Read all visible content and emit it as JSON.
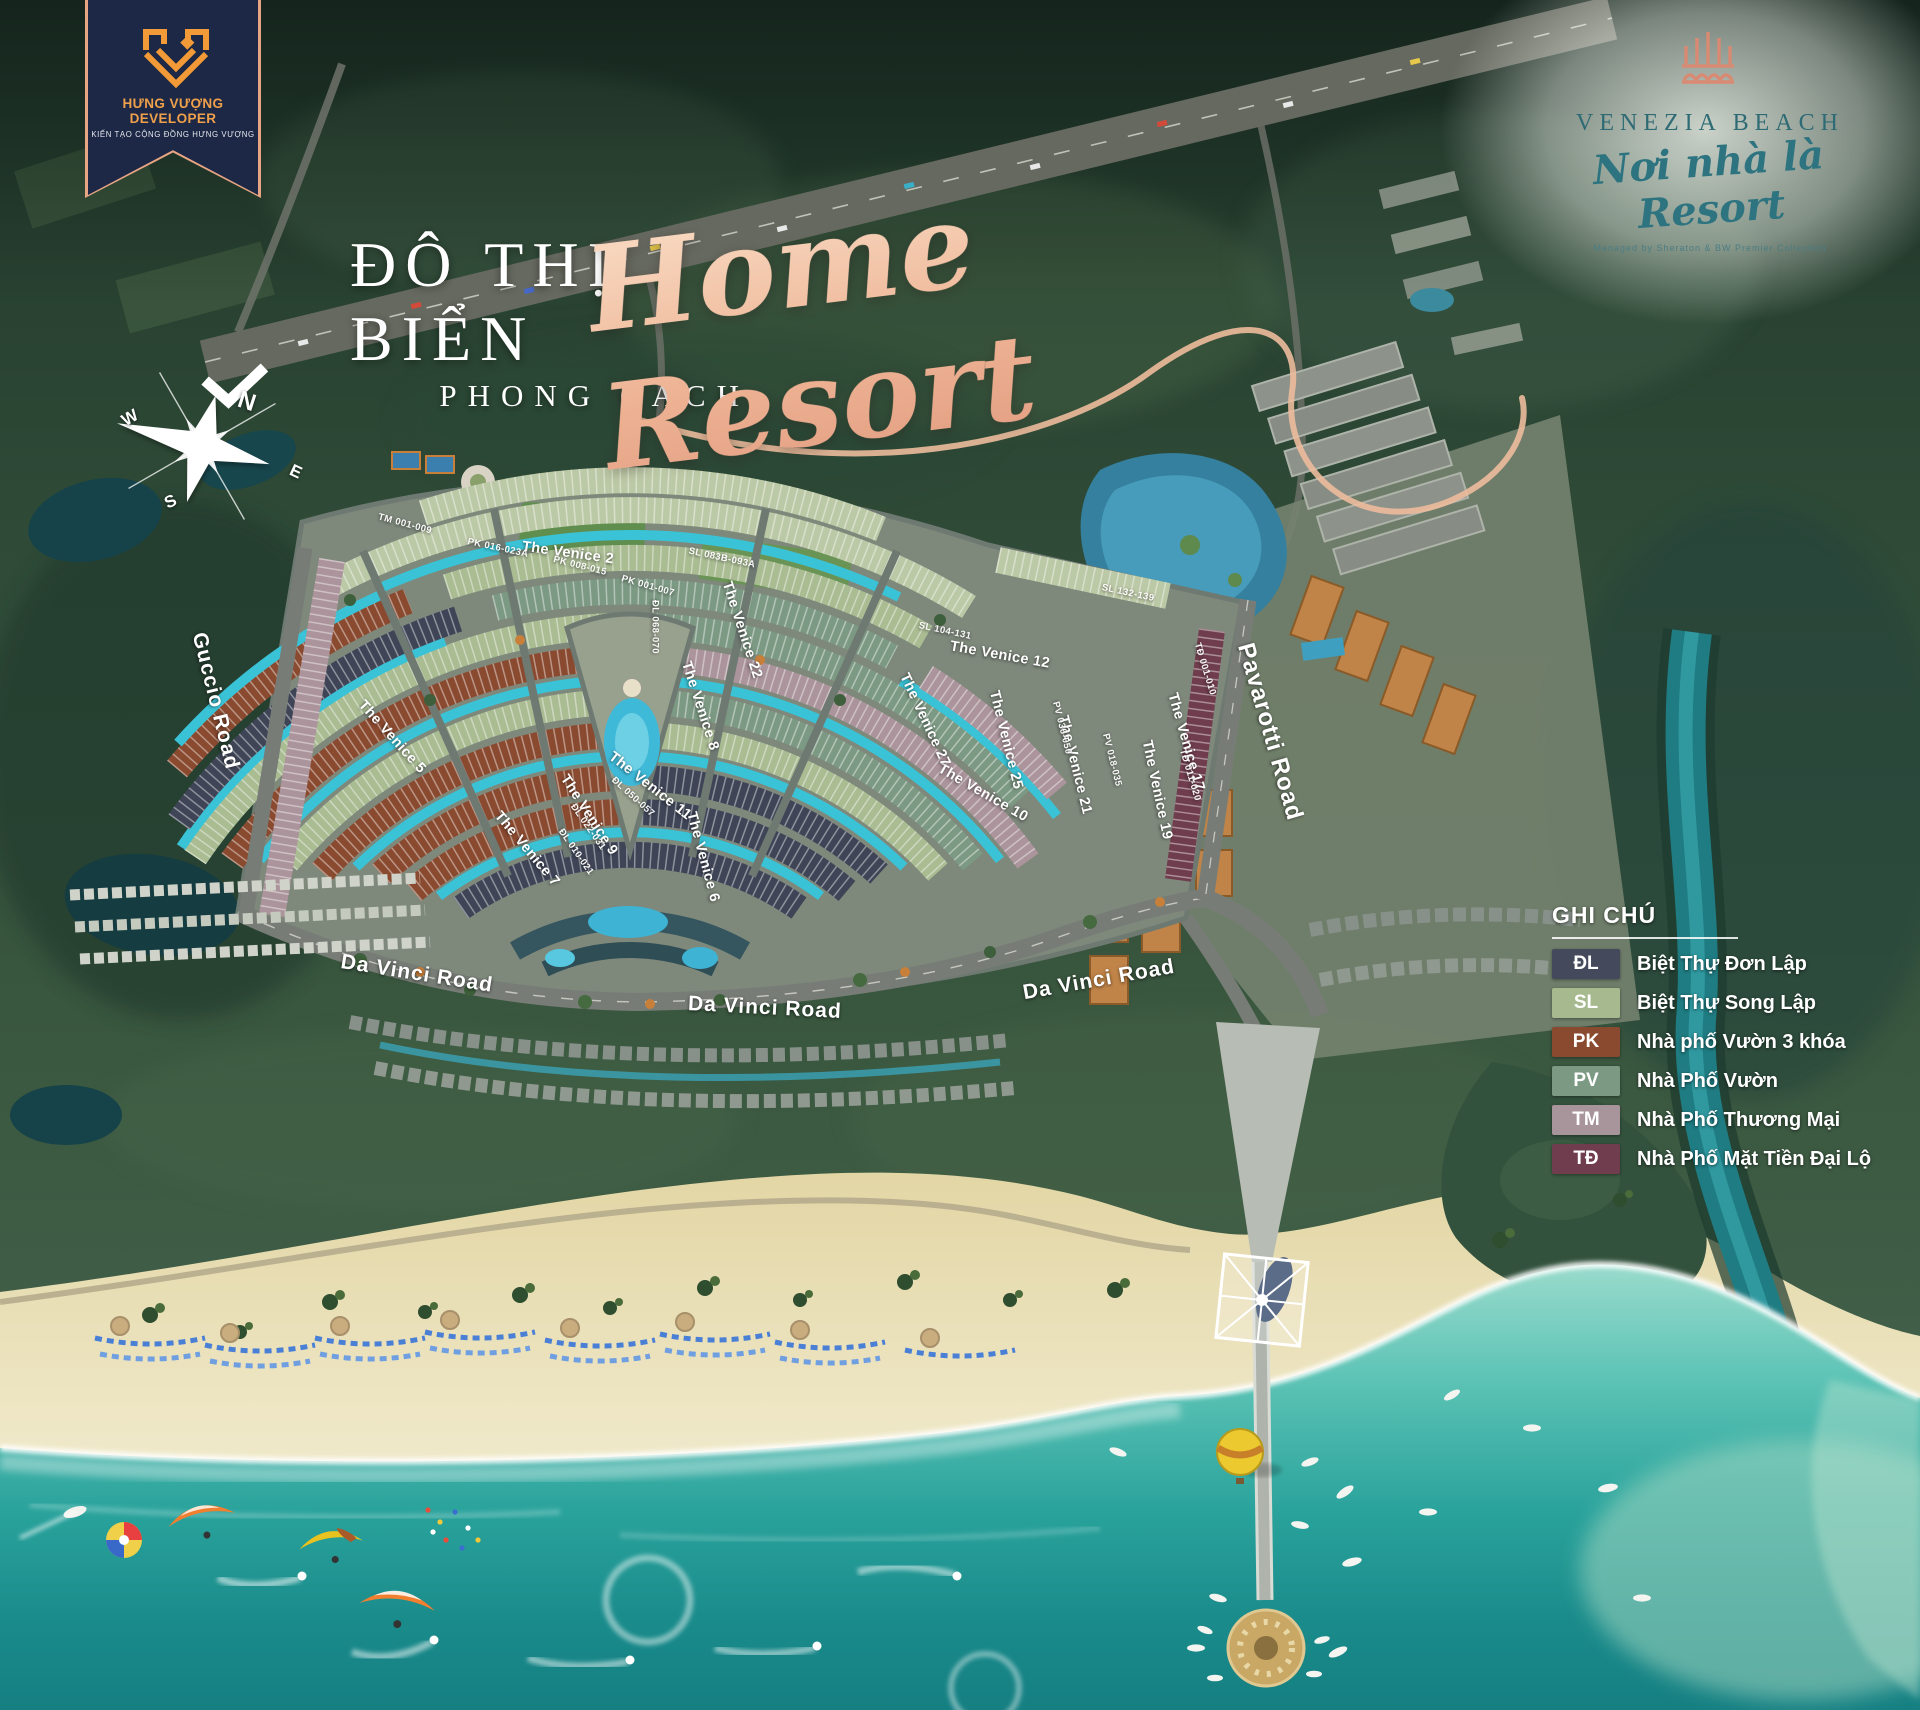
{
  "developer_badge": {
    "name": "HƯNG VƯỢNG DEVELOPER",
    "tagline": "KIẾN TẠO CỘNG ĐỒNG HƯNG VƯỢNG"
  },
  "project_logo": {
    "name": "VENEZIA BEACH",
    "slogan": "Nơi nhà là Resort",
    "managed_by": "Managed by Sheraton & BW Premier Collection"
  },
  "title": {
    "line1": "ĐÔ THỊ BIỂN",
    "line2": "PHONG CÁCH",
    "script": "Home Resort"
  },
  "compass": {
    "north": "N",
    "east": "E",
    "south": "S",
    "west": "W"
  },
  "legend": {
    "title": "GHI CHÚ",
    "items": [
      {
        "code": "ĐL",
        "label": "Biệt Thự Đơn Lập",
        "color": "#444a5c"
      },
      {
        "code": "SL",
        "label": "Biệt Thự Song Lập",
        "color": "#a6b98f"
      },
      {
        "code": "PK",
        "label": "Nhà phố Vườn 3 khóa",
        "color": "#8a4a30"
      },
      {
        "code": "PV",
        "label": "Nhà Phố Vườn",
        "color": "#7c9983"
      },
      {
        "code": "TM",
        "label": "Nhà Phố Thương Mại",
        "color": "#a8949b"
      },
      {
        "code": "TĐ",
        "label": "Nhà Phố Mặt Tiền Đại Lộ",
        "color": "#6f3d4d"
      }
    ]
  },
  "roads": {
    "guccio": "Guccio Road",
    "da_vinci": "Da Vinci Road",
    "pavarotti": "Pavarotti Road"
  },
  "streets": [
    "The Venice 2",
    "The Venice 5",
    "The Venice 6",
    "The Venice 7",
    "The Venice 8",
    "The Venice 9",
    "The Venice 10",
    "The Venice 11",
    "The Venice 12",
    "The Venice 17",
    "The Venice 19",
    "The Venice 21",
    "The Venice 22",
    "The Venice 25",
    "The Venice 27"
  ],
  "blocks": [
    "TM 001-009",
    "PK 016-023A",
    "PK 008-015",
    "PK 001-007",
    "SL 083B-093A",
    "SL 104-131",
    "SL 132-139",
    "ĐL 010-021",
    "ĐL 022-031",
    "ĐL 050-057",
    "ĐL 068-070",
    "PV 018-035",
    "PV 036-050",
    "TĐ 001-010",
    "TĐ 011-020"
  ],
  "colors": {
    "script_accent": "#eeb394",
    "canal": "#3ac3d6",
    "ocean_deep": "#157f82",
    "sand": "#f0e9cc",
    "badge_navy": "#1c2845",
    "badge_orange": "#f0a04a",
    "venezia_teal": "#2e6b74"
  }
}
